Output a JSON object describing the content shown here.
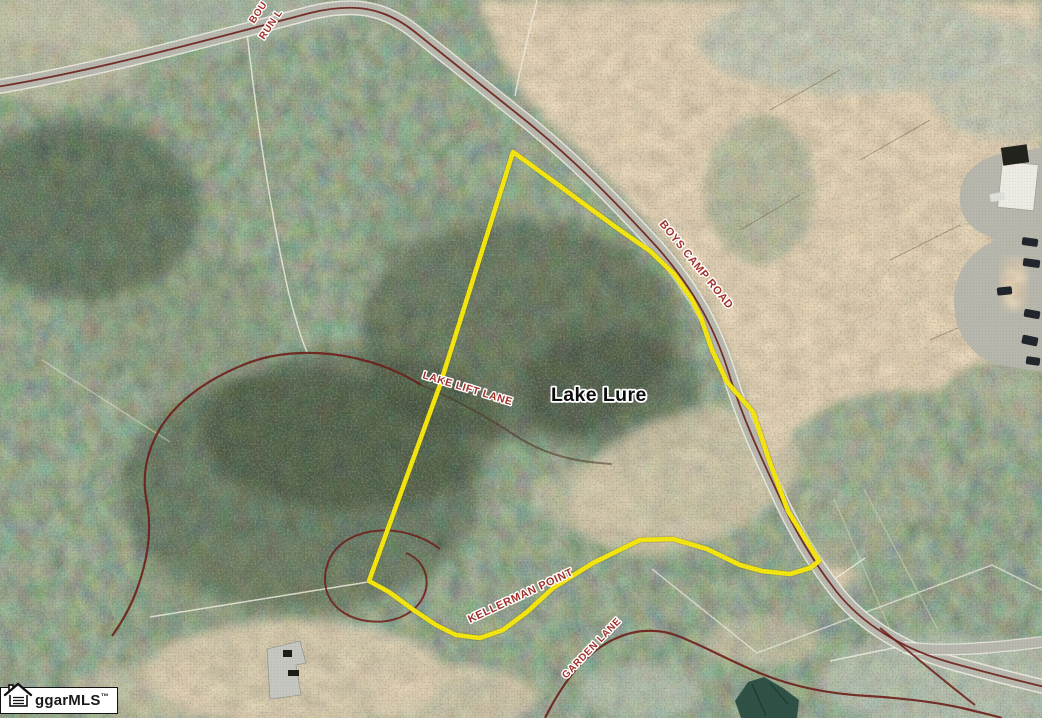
{
  "map": {
    "place_label": "Lake Lure",
    "roads": {
      "boys_camp_road": "BOYS CAMP ROAD",
      "lake_lift_lane": "LAKE LIFT LANE",
      "kellerman_point": "KELLERMAN POINT",
      "garden_lane": "GARDEN LANE",
      "top_edge_partial_line1": "BOU",
      "top_edge_partial_line2": "RUN L"
    },
    "colors": {
      "parcel_outline": "#f3e50f",
      "road_label": "#a03129",
      "place_label": "#0c0c0c",
      "trail_line": "#6d1f1a",
      "road_surface": "#b7b7ad"
    }
  },
  "watermark": {
    "brand": "ggarMLS",
    "trademark": "™",
    "icon": "house-icon"
  }
}
